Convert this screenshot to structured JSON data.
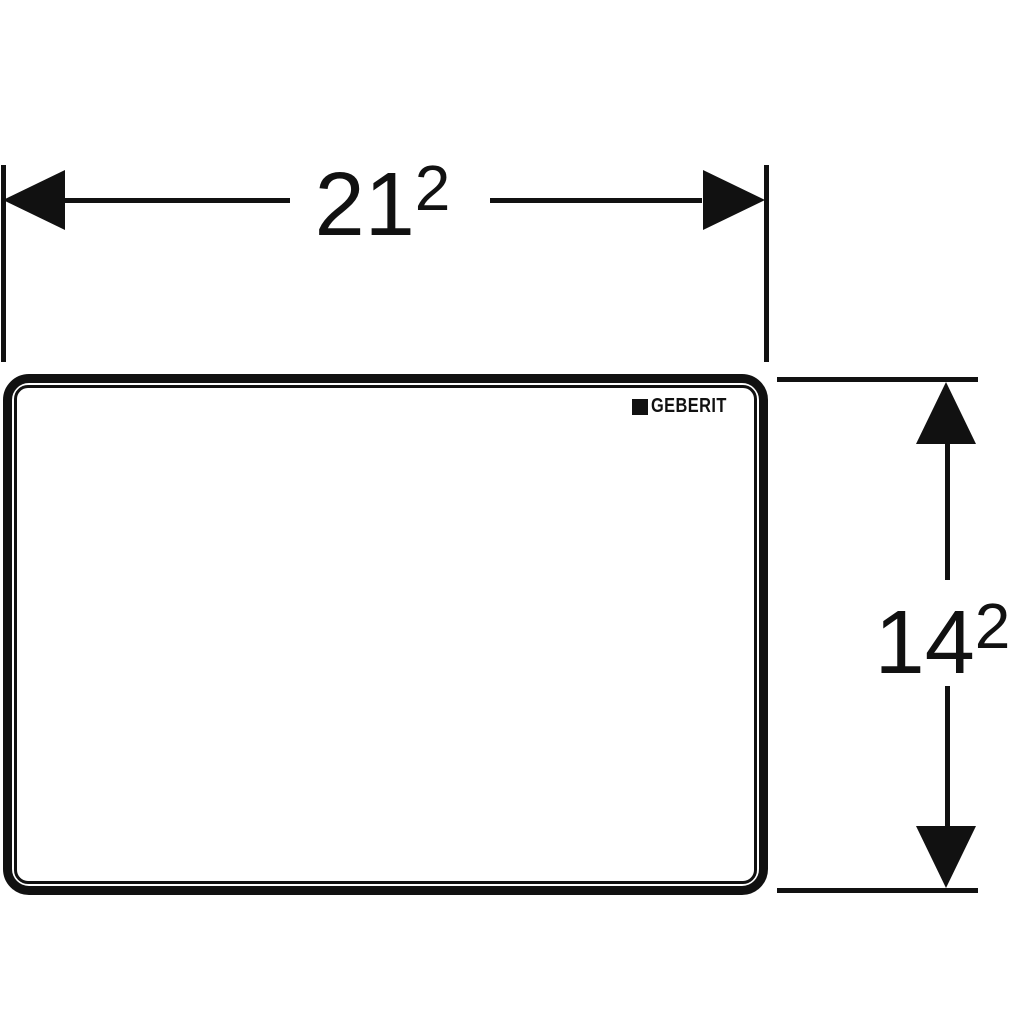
{
  "page": {
    "background": "#ffffff",
    "line_color": "#111111",
    "description": "Technical dimension drawing of a rectangular flush plate"
  },
  "dimensions": {
    "width": {
      "value": "21",
      "superscript": "2"
    },
    "height": {
      "value": "14",
      "superscript": "2"
    }
  },
  "plate": {
    "logo_text": "GEBERIT"
  }
}
